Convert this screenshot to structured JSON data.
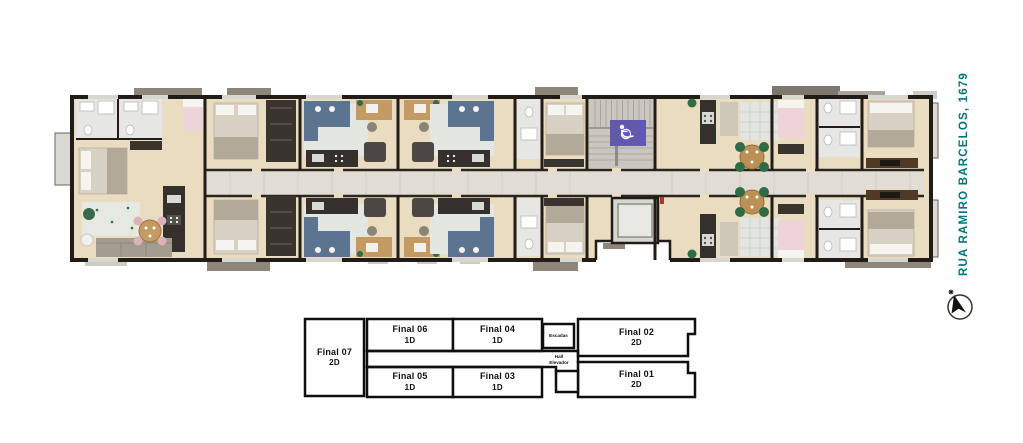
{
  "street_label": {
    "text": "RUA RAMIRO BARCELOS, 1679",
    "color": "#04737C"
  },
  "keyplan": {
    "units": [
      {
        "id": "final-07",
        "name": "Final 07",
        "type": "2D"
      },
      {
        "id": "final-06",
        "name": "Final 06",
        "type": "1D"
      },
      {
        "id": "final-04",
        "name": "Final 04",
        "type": "1D"
      },
      {
        "id": "final-02",
        "name": "Final 02",
        "type": "2D"
      },
      {
        "id": "final-05",
        "name": "Final 05",
        "type": "1D"
      },
      {
        "id": "final-03",
        "name": "Final 03",
        "type": "1D"
      },
      {
        "id": "final-01",
        "name": "Final 01",
        "type": "2D"
      }
    ],
    "stairs_label": "Escadas",
    "hall_label": [
      "Hall",
      "Elevador"
    ]
  },
  "floorplan": {
    "icons": {
      "accessibility": "wheelchair-accessibility-sign",
      "compass": "north-compass-arrow",
      "north_marker": "star-icon"
    },
    "colors": {
      "accent_teal": "#04737C",
      "accessibility_sign": "#6059AD",
      "wall": "#211C17",
      "unit_floor": "#E9DCC1",
      "corridor_floor": "#E1DDD4",
      "stairs_gray": "#C9C6C0",
      "balcony_gray": "#8E8679",
      "sofa_blue": "#5D7491",
      "chair_green": "#2F6B45",
      "bed_pink": "#EED3D7",
      "wood": "#C49A63",
      "counter_dark": "#34302B",
      "bathroom_floor": "#E6E7E5"
    }
  }
}
